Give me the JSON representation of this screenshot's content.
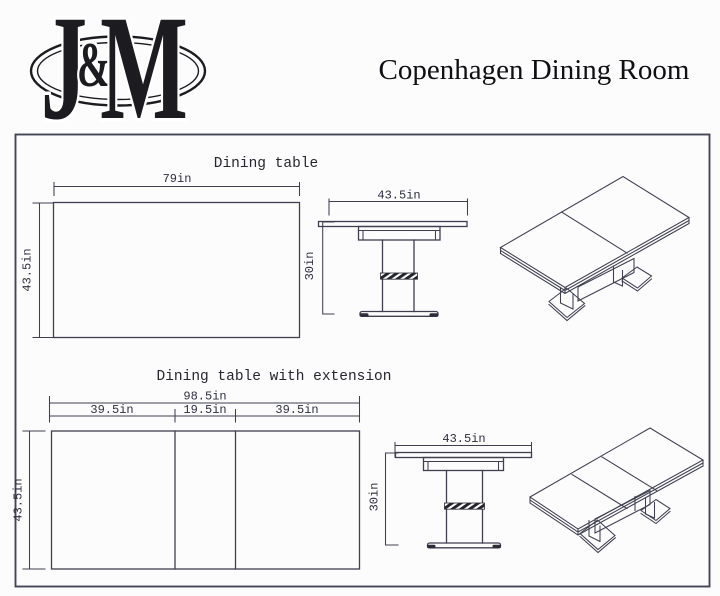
{
  "header": {
    "logo": {
      "j": "J",
      "amp": "&",
      "m": "M"
    },
    "title": "Copenhagen Dining Room"
  },
  "sections": [
    {
      "title": "Dining table",
      "top_view": {
        "width": "79in",
        "depth": "43.5in"
      },
      "front_view": {
        "width": "43.5in",
        "height": "30in"
      }
    },
    {
      "title": "Dining table with extension",
      "top_view": {
        "overall_width": "98.5in",
        "segments": [
          "39.5in",
          "19.5in",
          "39.5in"
        ],
        "depth": "43.5in"
      },
      "front_view": {
        "width": "43.5in",
        "height": "30in"
      }
    }
  ],
  "colors": {
    "line": "#3f3f50",
    "ink": "#1b1b20"
  }
}
